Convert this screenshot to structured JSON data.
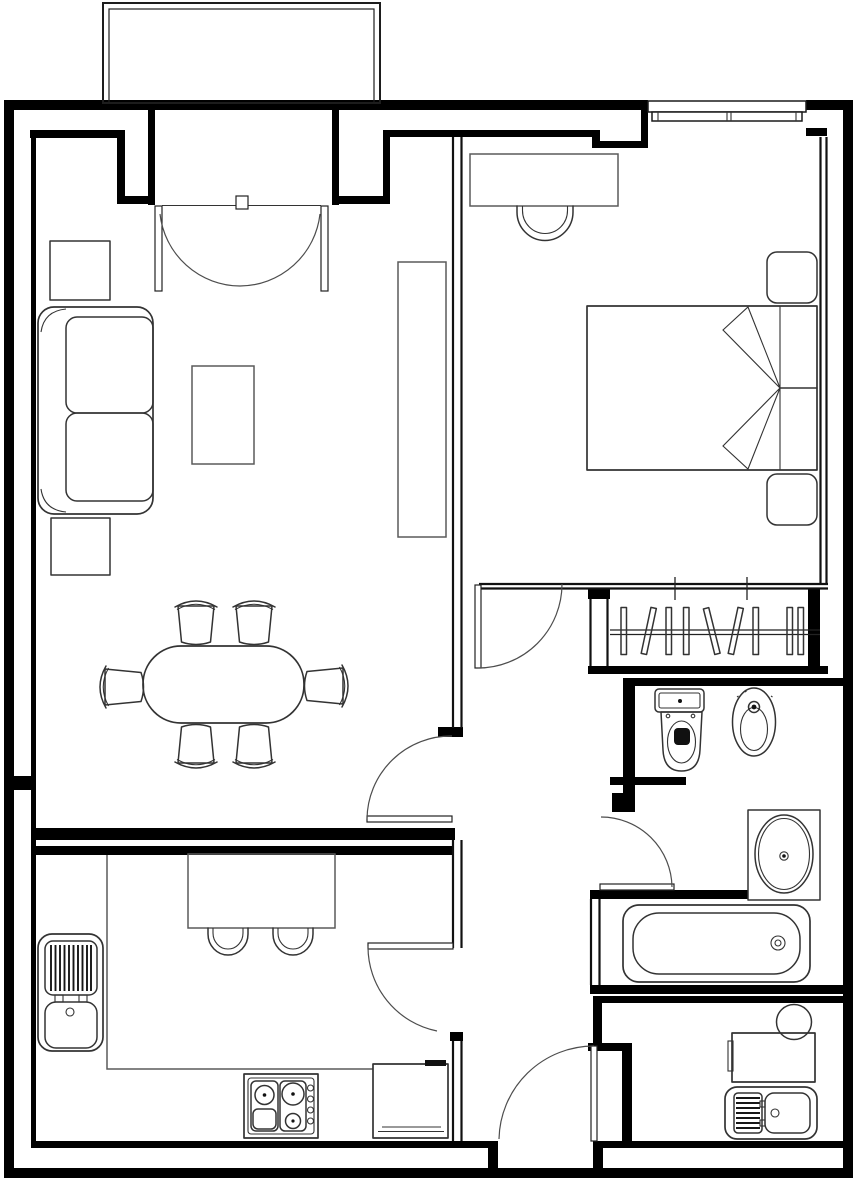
{
  "document": {
    "title": "Black-and-white architectural floor plan of a one-bedroom apartment",
    "drawing_style": "CAD line drawing, top-down plan view, no text labels",
    "background": "#ffffff"
  },
  "palette": {
    "wall_fill": "#000000",
    "cavity_wall_line": "#111111",
    "furniture_stroke": "#333333",
    "light_furniture_stroke": "#5a5a5a",
    "door_swing_stroke": "#4d4d4d",
    "fixture_fill": "#111111"
  },
  "rooms": [
    {
      "id": "balcony",
      "furniture": []
    },
    {
      "id": "living-dining-room",
      "furniture": [
        "sofa",
        "side-table-upper",
        "side-table-lower",
        "coffee-table",
        "media-sideboard",
        "dining-table",
        "dining-chairs-x6"
      ]
    },
    {
      "id": "bedroom",
      "furniture": [
        "double-bed",
        "blanket-fold-triangles",
        "nightstand-upper",
        "nightstand-lower",
        "desk",
        "desk-chair"
      ]
    },
    {
      "id": "walk-in-closet",
      "furniture": [
        "clothes-rail",
        "hangers-x9"
      ]
    },
    {
      "id": "bathroom",
      "furniture": [
        "toilet",
        "bidet",
        "washbasin-counter",
        "bathtub"
      ]
    },
    {
      "id": "kitchen",
      "furniture": [
        "double-sink-with-drainboard",
        "worktop-counter",
        "breakfast-table",
        "stools-x2",
        "cooktop-4-burner",
        "refrigerator"
      ]
    },
    {
      "id": "utility-room",
      "furniture": [
        "boiler-circle",
        "washing-machine",
        "laundry-sink-with-drainboard"
      ]
    },
    {
      "id": "hallway",
      "furniture": []
    }
  ],
  "openings": {
    "doors": [
      "balcony-french-doors",
      "bedroom-door",
      "living-room-door",
      "kitchen-door",
      "bathroom-door",
      "utility-room-door"
    ],
    "windows": [
      "bedroom-window"
    ]
  },
  "counts": {
    "rooms": 8,
    "doors": 6,
    "windows": 1,
    "dining_chairs": 6,
    "stools": 2,
    "hangers": 9,
    "burners": 3
  }
}
